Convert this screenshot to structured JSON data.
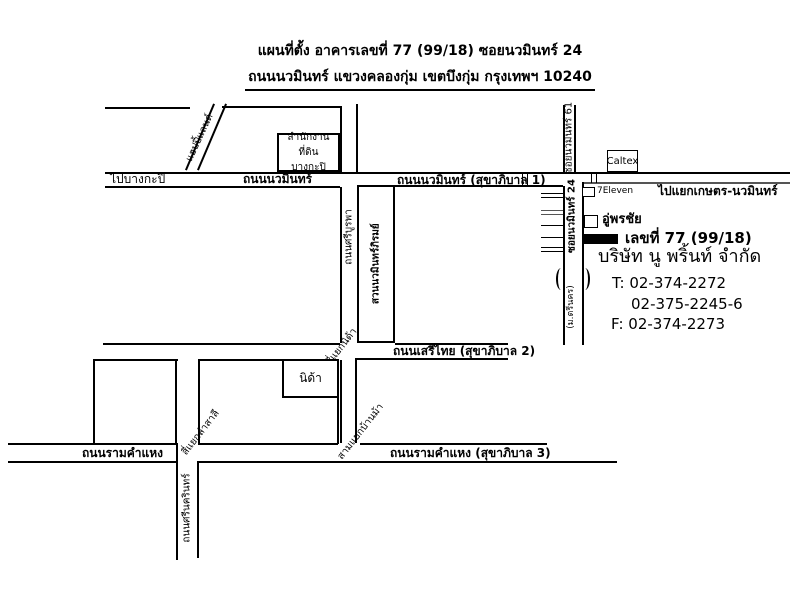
{
  "title": {
    "line1": "แผนที่ตั้ง อาคารเลขที่ 77 (99/18) ซอยนวมินทร์ 24",
    "line2": "ถนนนวมินทร์ แขวงคลองกุ่ม เขตบึงกุ่ม กรุงเทพฯ 10240"
  },
  "roads": {
    "to_bangkapi": "ไปบางกะปิ",
    "nawamin": "ถนนนวมินทร์",
    "nawamin_sukhaphiban1": "ถนนนวมินทร์ (สุขาภิบาล 1)",
    "to_kaset_nawamin": "ไปแยกเกษตร-นวมินทร์",
    "happy_land": "แฮปปี้แลนด์",
    "soi_nawamin_61": "ซอยนวมินทร์ 61",
    "soi_nawamin_24": "ซอยนวมินทร์ 24",
    "si_burapha": "ถนนศรีบูรพา",
    "serithai_sukhaphiban2": "ถนนเสรีไทย (สุขาภิบาล 2)",
    "ramkhamhaeng": "ถนนรามคำแหง",
    "ramkhamhaeng_sukhaphiban3": "ถนนรามคำแหง (สุขาภิบาล 3)",
    "srinagarindra": "ถนนศรีนครินทร์",
    "mu_trinakhon": "(ม.ตรีนคร)"
  },
  "junctions": {
    "nida": "สี่แยกนิด้า",
    "lamsali": "สี่แยกลำสาลี",
    "banma": "สามแยกบ้านม้า"
  },
  "places": {
    "land_office_line1": "สำนักงานที่ดิน",
    "land_office_line2": "บางกะปิ",
    "caltex": "Caltex",
    "seven_eleven": "7Eleven",
    "pornchai_garage": "อู่พรชัย",
    "nida": "นิด้า",
    "nawamin_phirom_park": "สวนนวมินทร์ภิรมย์"
  },
  "destination": {
    "address_no": "เลขที่ 77 (99/18)",
    "company": "บริษัท นู พริ้นท์ จำกัด",
    "tel_line1": "T: 02-374-2272",
    "tel_line2": "02-375-2245-6",
    "fax_line": "F: 02-374-2273"
  },
  "colors": {
    "line": "#000000",
    "background": "#ffffff",
    "marker": "#000000",
    "road_secondary": "#555555"
  }
}
